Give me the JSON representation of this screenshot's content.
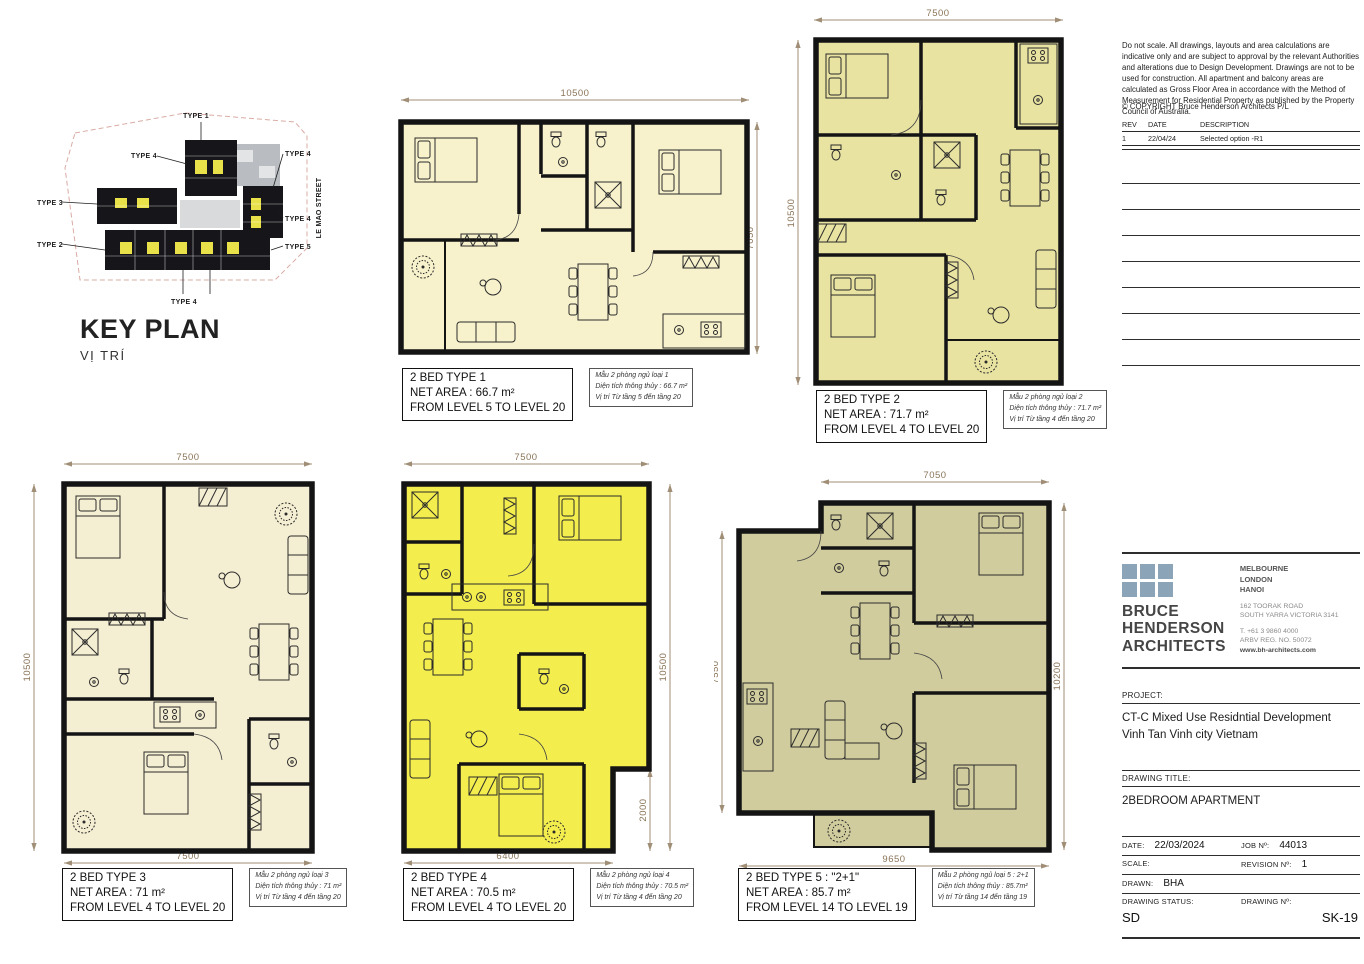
{
  "key_plan": {
    "title": "KEY PLAN",
    "subtitle": "VỊ TRÍ",
    "street": "LE MAO STREET",
    "labels": {
      "type1": "TYPE 1",
      "type4a": "TYPE 4",
      "type3": "TYPE 3",
      "type2": "TYPE 2",
      "type4b": "TYPE 4",
      "type4c": "TYPE 4",
      "type4d": "TYPE 4",
      "type5": "TYPE 5"
    },
    "highlight_color": "#e8e14a"
  },
  "plans": [
    {
      "title": "2 BED TYPE 1",
      "area": "NET AREA : 66.7 m²",
      "levels": "FROM LEVEL 5 TO LEVEL 20",
      "note1": "Mẫu 2 phòng ngủ loại 1",
      "note2": "Diện tích thông thủy : 66.7 m²",
      "note3": "Vị trí Từ tầng 5 đến tầng 20",
      "dim_top": "10500",
      "dim_right": "7050",
      "fill": "#f7f2cc"
    },
    {
      "title": "2 BED TYPE 2",
      "area": "NET AREA : 71.7 m²",
      "levels": "FROM LEVEL 4 TO LEVEL 20",
      "note1": "Mẫu 2 phòng ngủ loại 2",
      "note2": "Diện tích thông thủy : 71.7 m²",
      "note3": "Vị trí Từ tầng 4 đến tầng 20",
      "dim_top": "7500",
      "dim_left": "10500",
      "fill": "#e9e3a2"
    },
    {
      "title": "2 BED TYPE 3",
      "area": "NET AREA : 71 m²",
      "levels": "FROM LEVEL 4 TO LEVEL 20",
      "note1": "Mẫu 2 phòng ngủ loại 3",
      "note2": "Diện tích thông thủy : 71 m²",
      "note3": "Vị trí Từ tầng 4 đến tầng 20",
      "dim_top": "7500",
      "dim_left": "10500",
      "dim_bottom": "7500",
      "fill": "#f4eed2"
    },
    {
      "title": "2 BED TYPE 4",
      "area": "NET AREA : 70.5 m²",
      "levels": "FROM LEVEL 4 TO LEVEL 20",
      "note1": "Mẫu 2 phòng ngủ loại 4",
      "note2": "Diện tích thông thủy : 70.5 m²",
      "note3": "Vị trí Từ tầng 4 đến tầng 20",
      "dim_top": "7500",
      "dim_right": "10500",
      "dim_right2": "2000",
      "dim_bottom": "6400",
      "fill": "#f3ed4e"
    },
    {
      "title": "2 BED TYPE 5 : \"2+1\"",
      "area": "NET AREA : 85.7 m²",
      "levels": "FROM LEVEL 14 TO LEVEL 19",
      "note1": "Mẫu 2 phòng ngủ loại 5 : 2+1",
      "note2": "Diện tích thông thủy : 85.7m²",
      "note3": "Vị trí Từ tầng 14 đến tầng 19",
      "dim_top": "7050",
      "dim_left": "7550",
      "dim_right": "10200",
      "dim_bottom": "9650",
      "fill": "#d0cc9e"
    }
  ],
  "panel": {
    "disclaimer": "Do not scale. All drawings, layouts and area calculations are indicative only and are subject to approval by the relevant Authorities and alterations due to Design Development. Drawings are not to be used for construction. All apartment and balcony areas are calculated as Gross Floor Area in accordance with the Method of Measurement for Residential Property as published by the Property Council of Australia.",
    "copyright": "© COPYRIGHT Bruce Henderson Architects P/L",
    "rev": {
      "h_rev": "REV",
      "h_date": "DATE",
      "h_desc": "DESCRIPTION",
      "r_rev": "1",
      "r_date": "22/04/24",
      "r_desc": "Selected option -R1"
    },
    "firm": {
      "name1": "BRUCE",
      "name2": "HENDERSON",
      "name3": "ARCHITECTS",
      "city1": "MELBOURNE",
      "city2": "LONDON",
      "city3": "HANOI",
      "addr1": "162 TOORAK ROAD",
      "addr2": "SOUTH YARRA VICTORIA 3141",
      "tel": "T. +61 3 9860 4000",
      "reg": "ARBV REG. NO. 50072",
      "web": "www.bh-architects.com",
      "logo_color": "#8ba4b8"
    },
    "project_label": "PROJECT:",
    "project_line1": "CT-C Mixed Use Residntial Development",
    "project_line2": "Vinh Tan Vinh city Vietnam",
    "title_label": "DRAWING TITLE:",
    "title": "2BEDROOM APARTMENT",
    "date_label": "DATE:",
    "date": "22/03/2024",
    "job_label": "JOB Nº:",
    "job": "44013",
    "scale_label": "SCALE:",
    "scale": "",
    "revno_label": "REVISION Nº:",
    "revno": "1",
    "drawn_label": "DRAWN:",
    "drawn": "BHA",
    "status_label": "DRAWING STATUS:",
    "status": "SD",
    "dwg_label": "DRAWING Nº:",
    "dwg": "SK-19"
  }
}
